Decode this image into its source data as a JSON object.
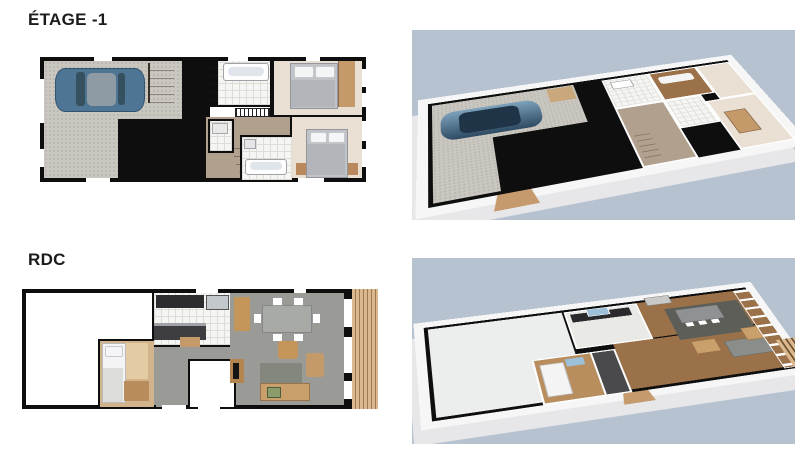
{
  "sections": [
    {
      "id": "etage-1",
      "title": "ÉTAGE -1"
    },
    {
      "id": "rdc",
      "title": "RDC"
    }
  ],
  "palette": {
    "page_bg": "#ffffff",
    "title_color": "#1b1b1b",
    "sky": "#b6c2d0",
    "wall": "#0e0e0e",
    "garage_floor": "#cac7c0",
    "cream_floor": "#eadfd3",
    "hall_floor": "#b1a08e",
    "tile_floor": "#f5f5f3",
    "tile_line": "#dedcd6",
    "wood_stairs": "#c9a87c",
    "deck_light": "#dcb88f",
    "deck_dark": "#9c7a54",
    "car_body": "#4e7694",
    "car_roof": "#8e9aa4",
    "gray_floor": "#9a9a97",
    "bed_gray": "#c0c3c7",
    "furn_wood": "#c49a6a",
    "building_white": "#f6f6f7",
    "building_side": "#e7e7ea",
    "wood_3d": "#9a7148",
    "rug_dark": "#5c5e57"
  }
}
